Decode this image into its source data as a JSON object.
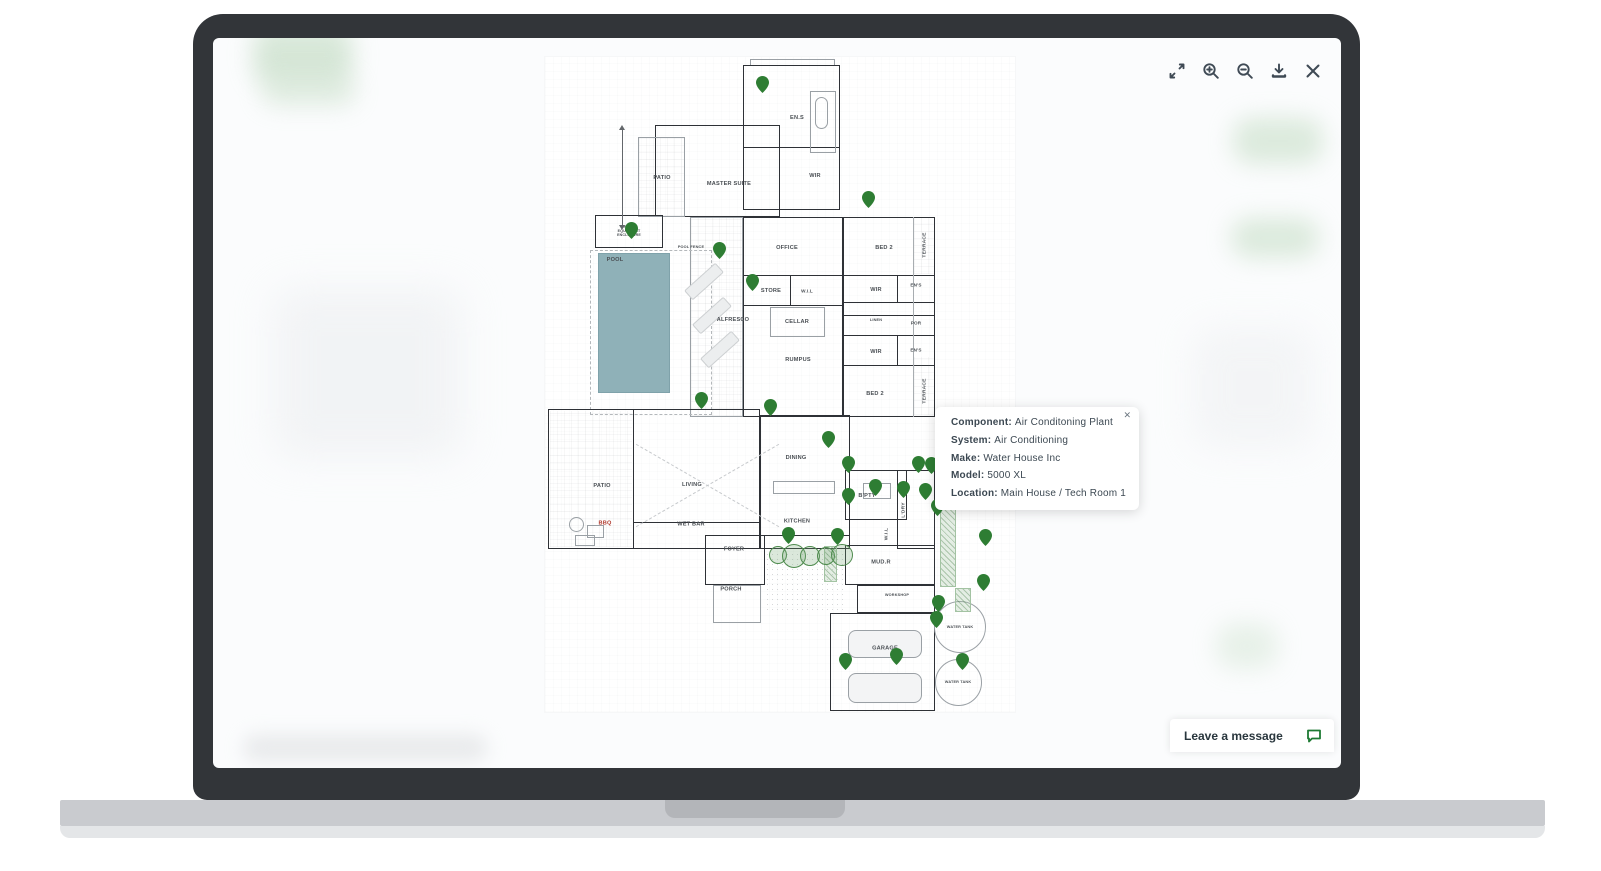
{
  "viewer": {
    "toolbar": {
      "icons": [
        "expand",
        "zoom-in",
        "zoom-out",
        "download",
        "close"
      ]
    },
    "tooltip": {
      "close": "✕",
      "fields": [
        {
          "label": "Component:",
          "value": "Air Conditoning Plant"
        },
        {
          "label": "System:",
          "value": "Air Conditioning"
        },
        {
          "label": "Make:",
          "value": "Water House Inc"
        },
        {
          "label": "Model:",
          "value": "5000 XL"
        },
        {
          "label": "Location:",
          "value": "Main House / Tech Room 1"
        }
      ]
    },
    "chat": {
      "label": "Leave a message"
    }
  },
  "colors": {
    "pin": "#2e7d33",
    "icon": "#3f4a55",
    "chat_icon": "#1d7a33",
    "pool": "#8fb1b8"
  },
  "floorplan": {
    "rooms": [
      {
        "label": "EN.S",
        "x": 252,
        "y": 60
      },
      {
        "label": "WIR",
        "x": 270,
        "y": 118
      },
      {
        "label": "PATIO",
        "x": 117,
        "y": 120
      },
      {
        "label": "MASTER SUITE",
        "x": 184,
        "y": 126
      },
      {
        "label": "POOL EQUIPMENT ENCLOSURE",
        "x": 84,
        "y": 174,
        "size": "multi"
      },
      {
        "label": "POOL FENCE",
        "x": 146,
        "y": 190,
        "size": "tiny"
      },
      {
        "label": "POOL",
        "x": 70,
        "y": 202
      },
      {
        "label": "OFFICE",
        "x": 242,
        "y": 190
      },
      {
        "label": "BED 2",
        "x": 339,
        "y": 190
      },
      {
        "label": "TERRACE",
        "x": 379,
        "y": 188,
        "vertical": true
      },
      {
        "label": "STORE",
        "x": 226,
        "y": 233
      },
      {
        "label": "W.I.L",
        "x": 262,
        "y": 234,
        "size": "small"
      },
      {
        "label": "WIR",
        "x": 331,
        "y": 232
      },
      {
        "label": "EN'S",
        "x": 371,
        "y": 228,
        "size": "small"
      },
      {
        "label": "LINEN",
        "x": 331,
        "y": 263,
        "size": "tiny"
      },
      {
        "label": "POR",
        "x": 371,
        "y": 266,
        "size": "small"
      },
      {
        "label": "CELLAR",
        "x": 252,
        "y": 264
      },
      {
        "label": "ALFRESCO",
        "x": 188,
        "y": 262
      },
      {
        "label": "RUMPUS",
        "x": 253,
        "y": 302
      },
      {
        "label": "WIR",
        "x": 331,
        "y": 294
      },
      {
        "label": "EN'S",
        "x": 371,
        "y": 293,
        "size": "small"
      },
      {
        "label": "BED 2",
        "x": 330,
        "y": 336
      },
      {
        "label": "TERRACE",
        "x": 379,
        "y": 334,
        "vertical": true
      },
      {
        "label": "PATIO",
        "x": 57,
        "y": 428
      },
      {
        "label": "LIVING",
        "x": 147,
        "y": 427
      },
      {
        "label": "DINING",
        "x": 251,
        "y": 400
      },
      {
        "label": "B'PTY",
        "x": 322,
        "y": 438
      },
      {
        "label": "KITCHEN",
        "x": 252,
        "y": 464
      },
      {
        "label": "WET BAR",
        "x": 146,
        "y": 467
      },
      {
        "label": "BBQ",
        "x": 60,
        "y": 466,
        "color": "#b03a2e"
      },
      {
        "label": "L'DRY",
        "x": 358,
        "y": 453,
        "vertical": true
      },
      {
        "label": "W.I.L",
        "x": 341,
        "y": 477,
        "vertical": true,
        "size": "tiny"
      },
      {
        "label": "FOYER",
        "x": 189,
        "y": 492
      },
      {
        "label": "MUD.R",
        "x": 336,
        "y": 505
      },
      {
        "label": "PORCH",
        "x": 186,
        "y": 532
      },
      {
        "label": "WORKSHOP",
        "x": 352,
        "y": 538,
        "size": "tiny"
      },
      {
        "label": "GARAGE",
        "x": 340,
        "y": 591
      },
      {
        "label": "WATER TANK",
        "x": 415,
        "y": 570,
        "size": "tiny"
      },
      {
        "label": "WATER TANK",
        "x": 413,
        "y": 625,
        "size": "tiny"
      }
    ],
    "pins": [
      {
        "x": 217,
        "y": 35
      },
      {
        "x": 323,
        "y": 150
      },
      {
        "x": 86,
        "y": 181
      },
      {
        "x": 174,
        "y": 201
      },
      {
        "x": 207,
        "y": 233
      },
      {
        "x": 156,
        "y": 351
      },
      {
        "x": 225,
        "y": 358
      },
      {
        "x": 283,
        "y": 390
      },
      {
        "x": 303,
        "y": 415
      },
      {
        "x": 303,
        "y": 447
      },
      {
        "x": 330,
        "y": 438
      },
      {
        "x": 358,
        "y": 440
      },
      {
        "x": 373,
        "y": 415
      },
      {
        "x": 386,
        "y": 416
      },
      {
        "x": 405,
        "y": 412
      },
      {
        "x": 380,
        "y": 442
      },
      {
        "x": 392,
        "y": 458
      },
      {
        "x": 243,
        "y": 486
      },
      {
        "x": 292,
        "y": 487
      },
      {
        "x": 440,
        "y": 488
      },
      {
        "x": 438,
        "y": 533
      },
      {
        "x": 393,
        "y": 554
      },
      {
        "x": 391,
        "y": 570
      },
      {
        "x": 351,
        "y": 607
      },
      {
        "x": 300,
        "y": 612
      },
      {
        "x": 417,
        "y": 612
      }
    ],
    "trees": [
      {
        "x": 232,
        "y": 497,
        "r": 8
      },
      {
        "x": 248,
        "y": 498,
        "r": 11
      },
      {
        "x": 264,
        "y": 498,
        "r": 9
      },
      {
        "x": 280,
        "y": 498,
        "r": 8
      },
      {
        "x": 296,
        "y": 497,
        "r": 10
      }
    ]
  }
}
